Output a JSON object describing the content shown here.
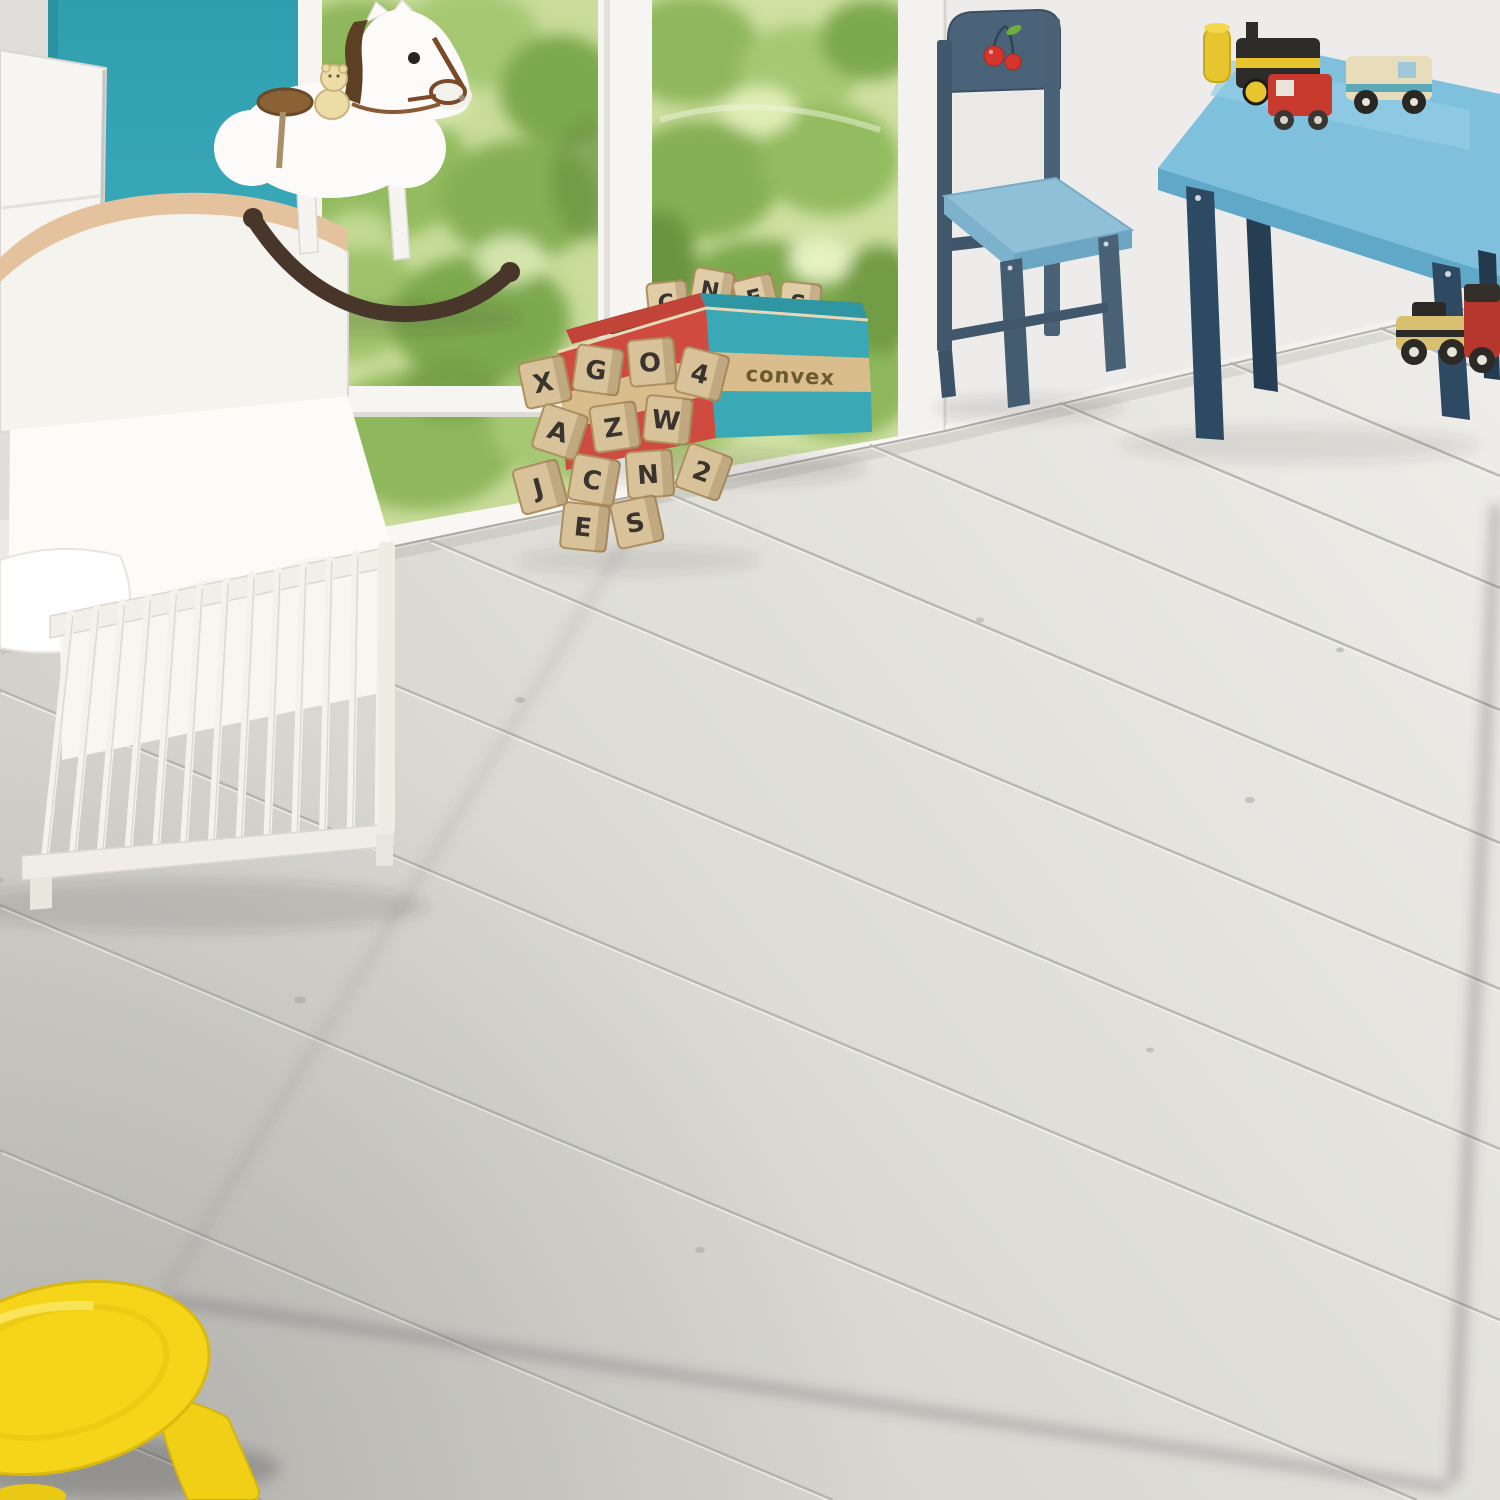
{
  "rug": {
    "squares": [
      {
        "id": "square-10",
        "number": "10",
        "pattern": "solid-teal"
      },
      {
        "id": "square-bear-silhouette",
        "animal": "bear-silhouette",
        "pattern": "cream"
      },
      {
        "id": "square-9",
        "number": "9",
        "pattern": "triangles"
      },
      {
        "id": "square-7",
        "number": "7",
        "pattern": "cream"
      },
      {
        "id": "square-5",
        "number": "5",
        "pattern": "teal-dots"
      },
      {
        "id": "square-fox",
        "animal": "fox-face",
        "pattern": "solid-teal"
      },
      {
        "id": "square-4",
        "number": "4",
        "pattern": "diagonal-stripes"
      },
      {
        "id": "square-bear-face",
        "animal": "bear-face",
        "pattern": "solid-teal"
      },
      {
        "id": "square-2",
        "number": "2",
        "pattern": "cream"
      },
      {
        "id": "square-1",
        "number": "1",
        "pattern": "chevron"
      }
    ],
    "doodles": [
      "bird",
      "star",
      "dandelion",
      "hedgehog",
      "feather-tree",
      "pine-tree",
      "rabbit",
      "star",
      "pine-tree",
      "bird"
    ],
    "geometry": {
      "flat_width": 900,
      "flat_height": 1750,
      "corners": [
        [
          683,
          447
        ],
        [
          1492,
          496
        ],
        [
          1447,
          1477
        ],
        [
          160,
          1295
        ]
      ]
    },
    "colors": {
      "base": "#efece2",
      "teal": "#7ba4a3",
      "ink": "#1e1d1b",
      "binding": "#bcb7c3"
    }
  },
  "toy_box": {
    "label": "convex",
    "colors": {
      "red": "#cf4a3f",
      "teal": "#3aa9b5",
      "tan": "#d9bd8c"
    }
  },
  "blocks": {
    "letters": [
      "X",
      "G",
      "O",
      "4",
      "A",
      "Z",
      "W",
      "J",
      "C",
      "N",
      "E",
      "S",
      "2"
    ],
    "wood": "#d8c29a",
    "ink": "#3a342e"
  },
  "palette": {
    "wall_teal": "#3ba8b8",
    "wall_white": "#edecea",
    "floor_light": "#e9e8e4",
    "floor_seam": "#b3b2ac",
    "window_frame": "#f6f5f2",
    "foliage_green": "#8fb75c",
    "crib_white": "#f6f4ef",
    "crib_trim": "#e2bf9b",
    "horse_white": "#fbfaf8",
    "horse_rocker_brown": "#49362a",
    "horse_saddle": "#8a6236",
    "chair_frame": "#45607a",
    "chair_seat": "#8fc0d8",
    "cherry_red": "#d5352c",
    "leaf_green": "#6fae3a",
    "table_top": "#7fc0dd",
    "table_leg": "#2e4a63",
    "stool_yellow": "#f4d519"
  }
}
